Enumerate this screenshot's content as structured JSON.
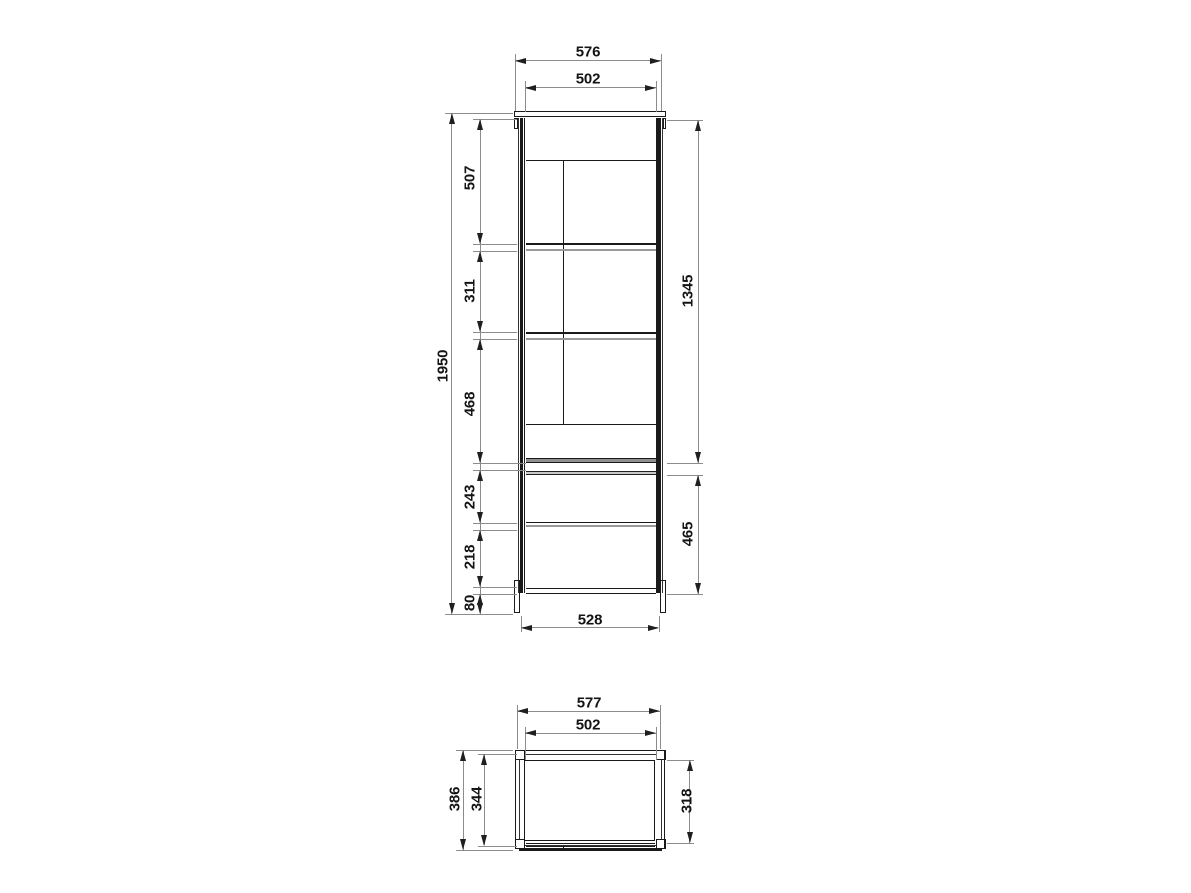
{
  "drawing": {
    "type": "furniture technical drawing",
    "views": [
      "front elevation",
      "top plan"
    ]
  },
  "front": {
    "dim_overall_width": "576",
    "dim_inner_width": "502",
    "dim_overall_height": "1950",
    "dim_top_section": "507",
    "dim_middle_section": "311",
    "dim_lower_section": "468",
    "dim_drawer_section": "243",
    "dim_base_section": "218",
    "dim_plinth": "80",
    "dim_door_height": "1345",
    "dim_base_height": "465",
    "dim_base_width": "528"
  },
  "plan": {
    "dim_overall_width": "577",
    "dim_inner_width": "502",
    "dim_overall_depth": "386",
    "dim_mid_depth": "344",
    "dim_inner_depth": "318"
  },
  "colors": {
    "line": "#1a1a1a",
    "dim_line": "#8c8c8c",
    "fill_dark": "#8f8f8f",
    "fill_light": "#c9c9c9",
    "background": "#ffffff"
  }
}
